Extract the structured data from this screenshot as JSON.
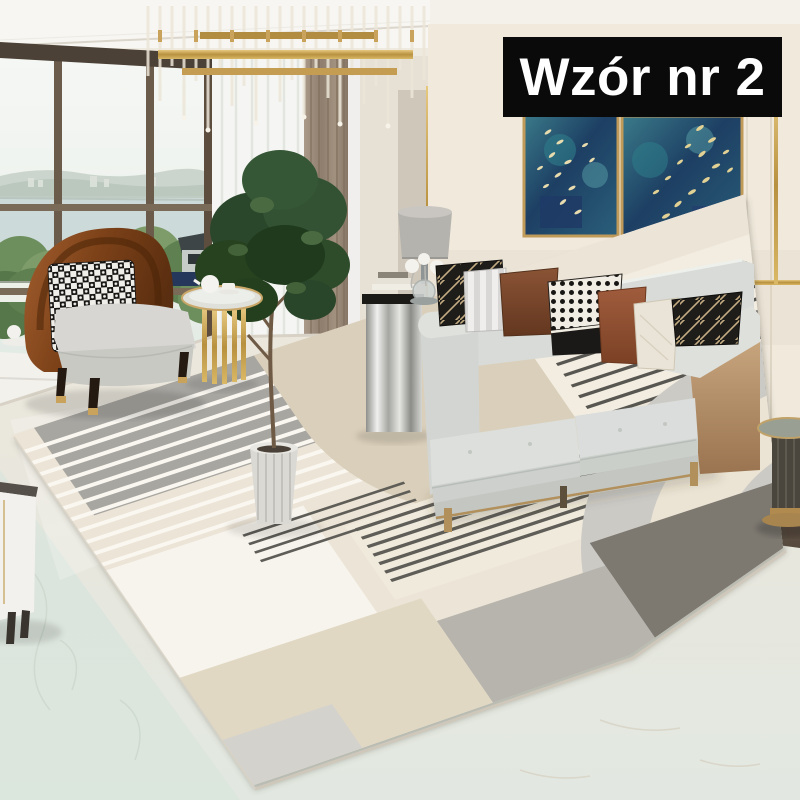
{
  "overlay": {
    "label": "Wzór nr 2",
    "bg_color": "#0a0a0a",
    "text_color": "#ffffff"
  },
  "scene": {
    "description": "Modern living room product photo showcasing a beige and grey geometric area rug",
    "objects": [
      "chandelier",
      "window",
      "window-view",
      "sheer-curtain",
      "taupe-drape",
      "side-wall-art",
      "wall-art-left",
      "wall-art-right",
      "table-lamp",
      "chrome-side-table",
      "books",
      "sofa",
      "throw-pillows",
      "accent-chair",
      "houndstooth-pillow",
      "gold-side-table",
      "tea-set",
      "potted-plant",
      "planter",
      "pedestal-side-table",
      "white-cabinet",
      "area-rug",
      "marble-floor"
    ]
  },
  "palette": {
    "label_bg": "#0a0a0a",
    "label_text": "#ffffff",
    "wall_cream": "#f0e9dc",
    "gold_trim": "#c9a25c",
    "sofa_grey": "#d8dbd7",
    "sofa_leather_tan": "#c9a77f",
    "chair_leather_brown": "#7c4118",
    "rust_pillow": "#9a573a",
    "art_navy": "#1d3f63",
    "rug_cream": "#ebe3d4",
    "rug_beige": "#d8cdb6",
    "rug_grey_dark": "#757169",
    "floor_marble": "#e4e9e2"
  }
}
